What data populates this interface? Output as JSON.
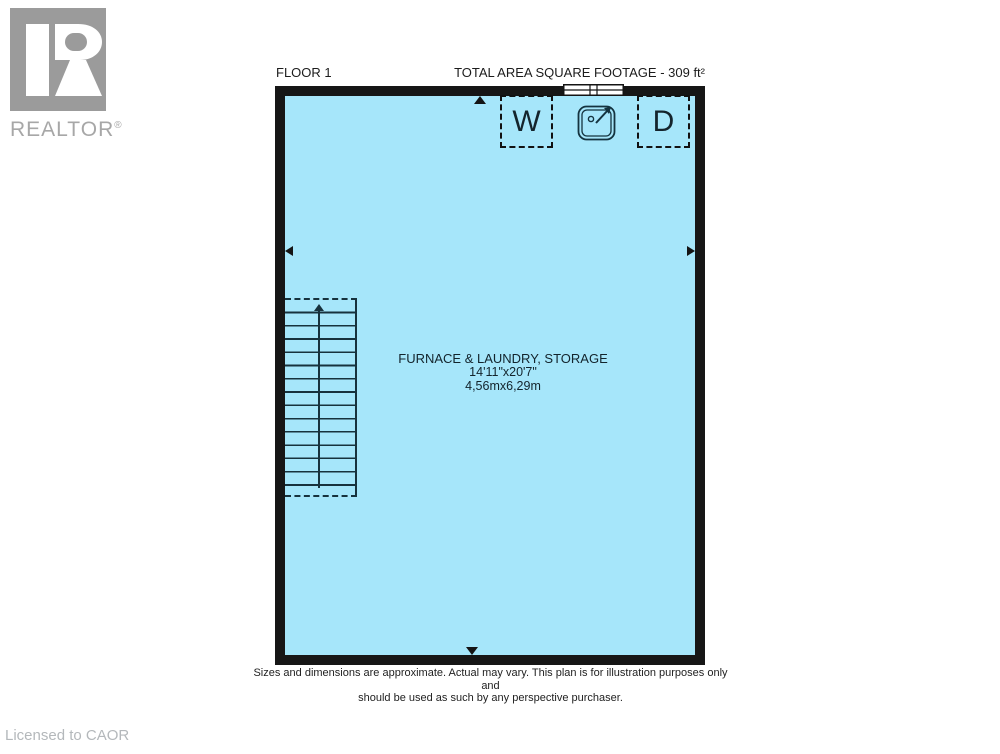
{
  "branding": {
    "logo_text": "REALTOR",
    "registered": "®",
    "licensed": "Licensed to CAOR"
  },
  "header": {
    "floor": "FLOOR 1",
    "area": "TOTAL AREA SQUARE FOOTAGE - 309 ft²"
  },
  "room": {
    "name": "FURNACE & LAUNDRY, STORAGE",
    "imperial": "14'11\"x20'7\"",
    "metric": "4,56mx6,29m"
  },
  "fixtures": {
    "washer": "W",
    "dryer": "D",
    "sink_icon": "laundry-sink-icon",
    "window_icon": "window-symbol",
    "stairs": {
      "treads": 15,
      "direction": "up"
    },
    "dimension_arrows": [
      "up",
      "down",
      "left",
      "right"
    ]
  },
  "disclaimer": {
    "line1": "Sizes and dimensions are approximate. Actual may vary. This plan is for illustration purposes only and",
    "line2": "should be used as such by any perspective purchaser."
  },
  "colors": {
    "floor_fill": "#a6e6fa",
    "wall": "#161616",
    "logo_gray": "#9b9b9b",
    "licensed_gray": "#b4b8bb"
  }
}
